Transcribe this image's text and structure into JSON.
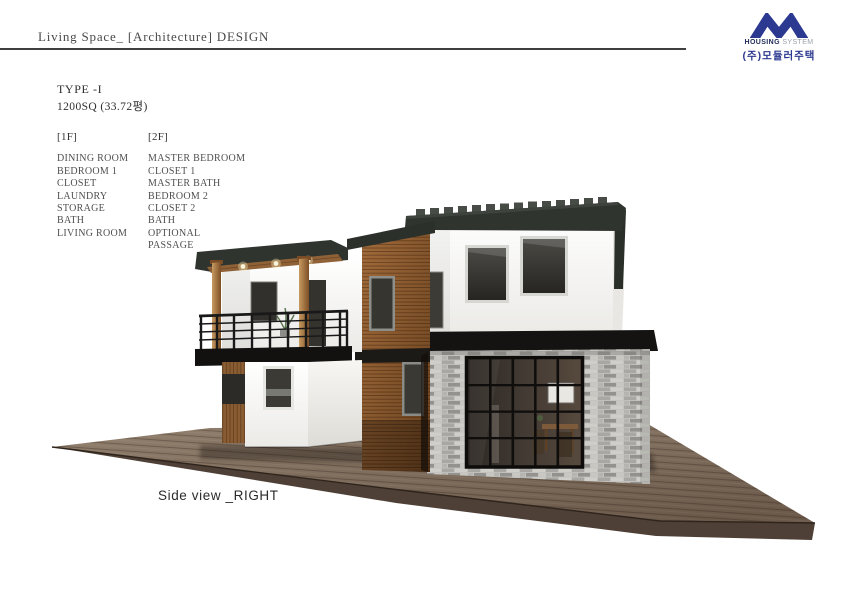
{
  "header": {
    "title": "Living Space_ [Architecture] DESIGN"
  },
  "logo": {
    "name_bold": "HOUSING",
    "name_light": "SYSTEM",
    "company": "(주)모듈러주택",
    "accent_color": "#2b3990"
  },
  "plan": {
    "type": "TYPE -I",
    "area": "1200SQ (33.72평)",
    "floors": [
      {
        "label": "[1F]",
        "rooms": [
          "DINING ROOM",
          "BEDROOM 1",
          "CLOSET",
          "LAUNDRY",
          "STORAGE",
          "BATH",
          "LIVING ROOM"
        ]
      },
      {
        "label": "[2F]",
        "rooms": [
          "MASTER BEDROOM",
          "CLOSET 1",
          "MASTER BATH",
          "BEDROOM 2",
          "CLOSET 2",
          "BATH",
          "OPTIONAL",
          "PASSAGE"
        ]
      }
    ]
  },
  "caption": "Side view _RIGHT",
  "illustration": {
    "alt": "3D exterior rendering of a two-story modular house with balcony, wood cladding, gray brick base and wooden deck, right side view",
    "colors": {
      "roof": "#30342f",
      "wood": "#8a5a33",
      "brick": "#b7b6b2",
      "deck": "#7b6a58"
    }
  }
}
